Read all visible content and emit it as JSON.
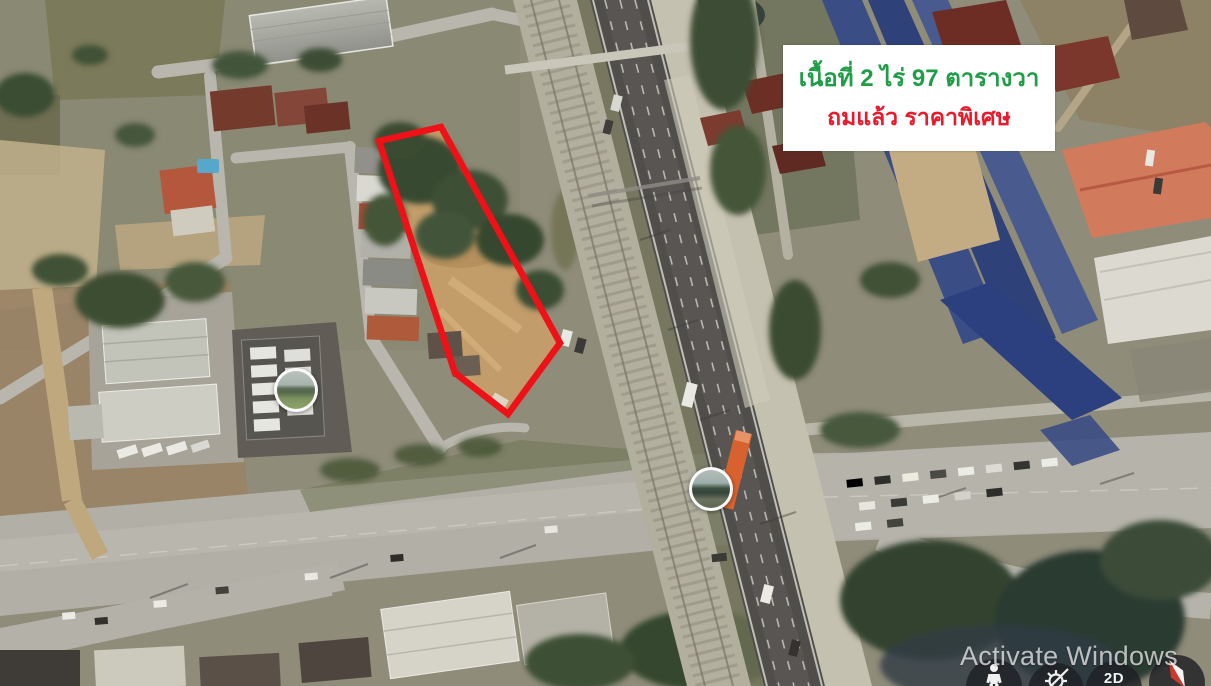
{
  "annotation": {
    "line1": "เนื้อที่ 2 ไร่  97 ตารางวา",
    "line2": "ถมแล้ว ราคาพิเศษ",
    "line1_color": "#1e9e46",
    "line2_color": "#e81a2c",
    "background": "#ffffff"
  },
  "plot": {
    "outline_points": "379,141 441,127 560,343 508,414 455,373",
    "outline_color": "#ee1118",
    "outline_width": "6.5"
  },
  "markers": [
    {
      "id": "photo-marker-north",
      "type": "street-photo-thumbnail"
    },
    {
      "id": "photo-marker-south",
      "type": "street-photo-thumbnail"
    }
  ],
  "controls": {
    "pegman": {
      "icon": "pegman-icon"
    },
    "settings": {
      "icon": "gear-icon"
    },
    "view_toggle": {
      "label": "2D"
    },
    "compass": {
      "icon": "compass-icon"
    }
  },
  "watermark": {
    "text": "Activate Windows"
  }
}
